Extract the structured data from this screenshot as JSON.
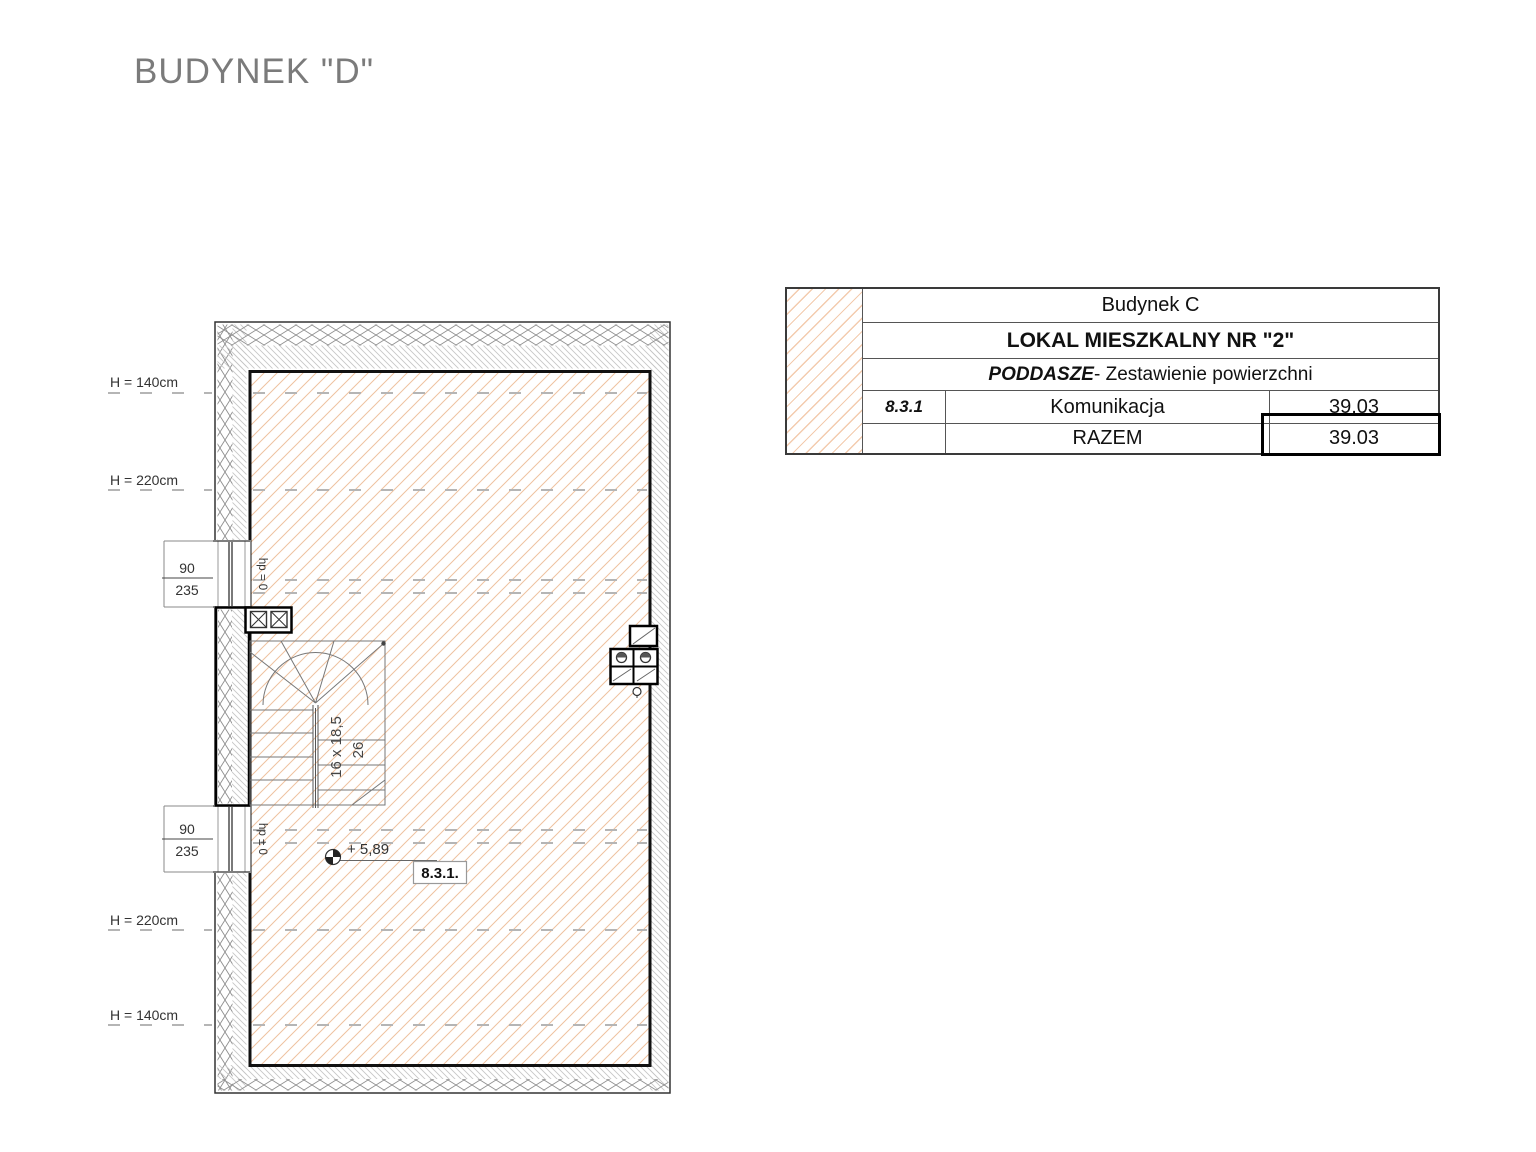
{
  "title": "BUDYNEK \"D\"",
  "colors": {
    "floor_hatch": "#eec2a0",
    "wall_line": "#111111",
    "title_gray": "#7b7b7b"
  },
  "plan": {
    "height_labels": [
      "H = 140cm",
      "H = 220cm",
      "H = 220cm",
      "H = 140cm"
    ],
    "windows": [
      {
        "width": "90",
        "height": "235",
        "sill": "hp = 0"
      },
      {
        "width": "90",
        "height": "235",
        "sill": "hp ± 0"
      }
    ],
    "stairs": {
      "riser": "16 x 18,5",
      "width": "26"
    },
    "level_mark": "+ 5,89",
    "room_number": "8.3.1."
  },
  "table": {
    "building": "Budynek C",
    "unit": "LOKAL MIESZKALNY NR \"2\"",
    "floor": "PODDASZE",
    "floor_suffix": " - Zestawienie powierzchni",
    "rows": [
      {
        "no": "8.3.1",
        "name": "Komunikacja",
        "area": "39,03"
      },
      {
        "no": "",
        "name": "RAZEM",
        "area": "39.03"
      }
    ]
  }
}
